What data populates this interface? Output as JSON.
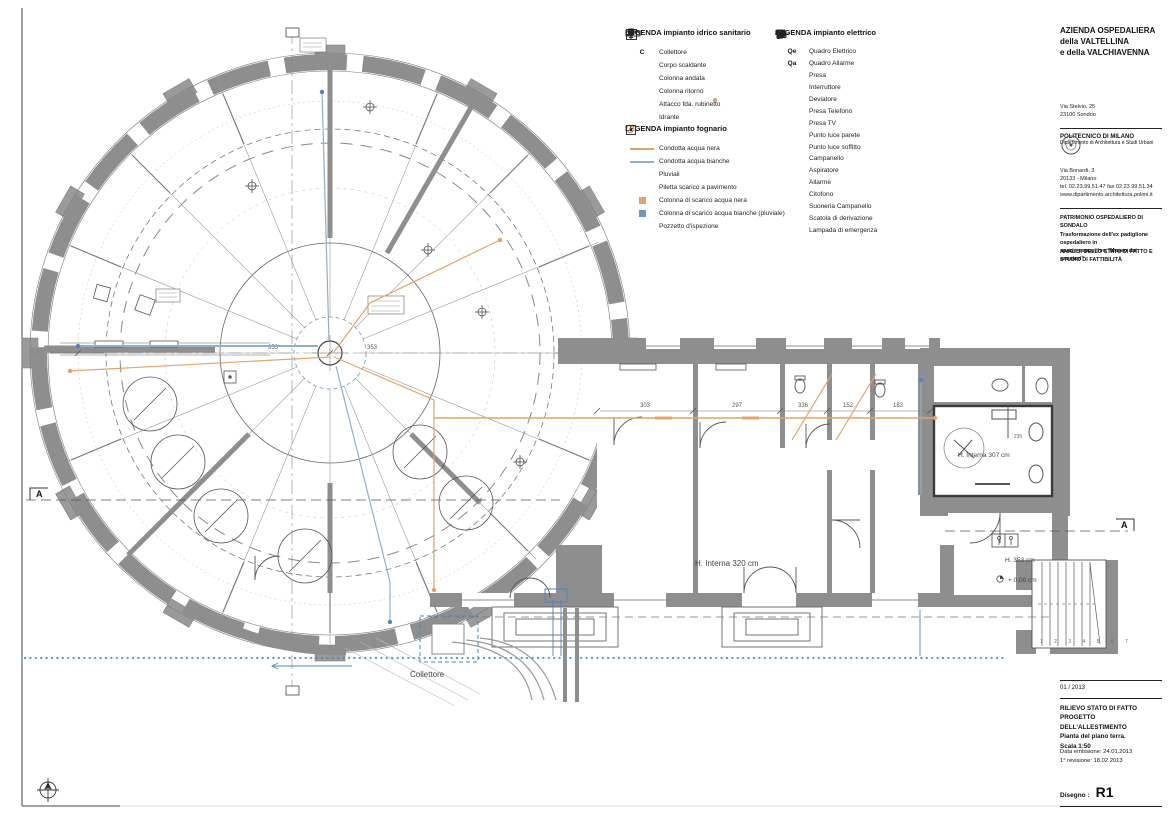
{
  "legends": {
    "idrico": {
      "title": "LEGENDA impianto idrico sanitario",
      "items": [
        {
          "symbol": "C",
          "label": "Collettore"
        },
        {
          "label": "Corpo scaldante"
        },
        {
          "label": "Colonna andata"
        },
        {
          "label": "Colonna ritorno"
        },
        {
          "label": "Attacco fda. rubinetto"
        },
        {
          "label": "Idrante"
        }
      ]
    },
    "fognario": {
      "title": "LEGENDA impianto fognario",
      "items": [
        {
          "label": "Condotta acqua nera"
        },
        {
          "label": "Condotta acqua bianche"
        },
        {
          "label": "Pluviali"
        },
        {
          "label": "Piletta scarico a pavimento"
        },
        {
          "label": "Colonna di scarico acqua nera"
        },
        {
          "label": "Colonna di scarico acqua bianche (pluviale)"
        },
        {
          "label": "Pozzetto d'ispezione"
        }
      ]
    },
    "elettrico": {
      "title": "LEGENDA impianto elettrico",
      "items": [
        {
          "symbol": "Qe",
          "label": "Quadro Elettrico"
        },
        {
          "symbol": "Qa",
          "label": "Quadro Allarme"
        },
        {
          "label": "Presa"
        },
        {
          "label": "Interruttore"
        },
        {
          "label": "Deviatore"
        },
        {
          "label": "Presa Telefono"
        },
        {
          "label": "Presa TV"
        },
        {
          "label": "Punto luce parete"
        },
        {
          "label": "Punto luce soffitto"
        },
        {
          "label": "Campanello"
        },
        {
          "label": "Aspiratore"
        },
        {
          "label": "Allarme"
        },
        {
          "label": "Citofono"
        },
        {
          "label": "Suoneria Campanello"
        },
        {
          "label": "Scatola di derivazione"
        },
        {
          "label": "Lampada di emergenza"
        }
      ]
    }
  },
  "titleblock": {
    "client": [
      "AZIENDA OSPEDALIERA",
      "della VALTELLINA",
      "e della VALCHIAVENNA"
    ],
    "client_address": [
      "Via Stelvio, 25",
      "23100 Sondrio"
    ],
    "university": "POLITECNICO DI MILANO",
    "department": "Dipartimento di Architettura e Studi Urbani",
    "university_address": [
      "Via Bonardi, 3",
      "20133 - Milano",
      "tel. 02.23.99.51.47  fax 02.23.99.51.34",
      "www.dipartimento.architettura.polimi.it"
    ],
    "project": [
      "PATRIMONIO OSPEDALIERO DI SONDALO",
      "Trasformazione dell'ex padiglione ospedaliero in",
      "spazio espositivo \"Museo dei sanatori\""
    ],
    "phase": [
      "ANALISI DELLO STATO DI FATTO E",
      "STUDIO DI FATTIBILITÀ"
    ],
    "sheet_date": "01 / 2013",
    "drawing_title": [
      "RILIEVO STATO DI FATTO",
      "PROGETTO DELL'ALLESTIMENTO",
      "Pianta del piano terra.",
      "Scala 1:50"
    ],
    "revisions": [
      "Data emissione: 24.01.2013",
      "1° revisione: 18.02.2013"
    ],
    "drawing_label": "Disegno :",
    "drawing_code": "R1"
  },
  "plan": {
    "labels": {
      "h_interna_320": "H. Interna 320 cm",
      "h_interna_307": "H. Interna 307 cm",
      "h_353": "H. 353 cm",
      "quota_zero": "+ 0,00 cm",
      "collettore": "Collettore",
      "stair_numbers": "1 2 3 4 5 6 7"
    },
    "dims": {
      "d353a": "353",
      "d353b": "353",
      "d303": "303",
      "d297": "297",
      "d336": "336",
      "d152": "152",
      "d183": "183",
      "d235": "235"
    },
    "sections": {
      "a": "A"
    }
  },
  "colors": {
    "acqua_nera": "#E3A469",
    "acqua_bianche": "#8FAFCB",
    "collector_blue": "#4D86C2",
    "wall_gray": "#8E8E8E"
  }
}
